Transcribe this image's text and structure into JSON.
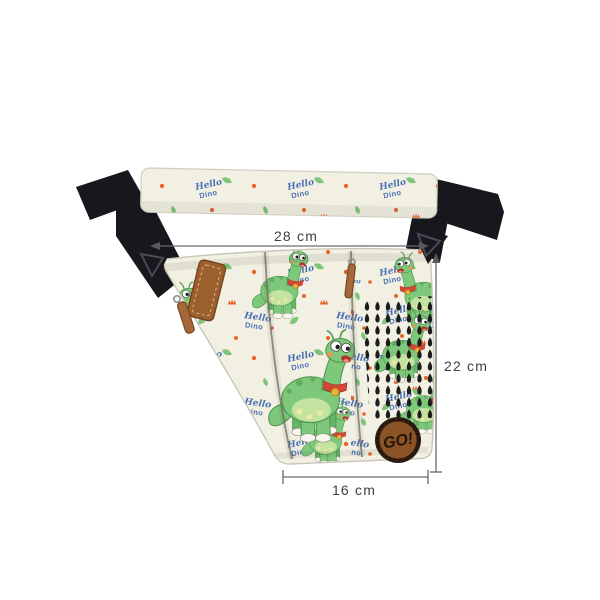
{
  "annotations": {
    "top_width_label": "28 cm",
    "side_height_label": "22 cm",
    "bottom_width_label": "16 cm"
  },
  "bag": {
    "print": {
      "hello": "Hello",
      "dino": "Dino"
    },
    "badge_label": "GO!"
  },
  "colors": {
    "background": "#ffffff",
    "fabric_cream": "#f1f0e2",
    "strap_black": "#17171d",
    "dino_green": "#7ec87b",
    "leaf_green": "#7ec57a",
    "print_blue": "#4b6fb5",
    "accent_orange": "#e8632c",
    "collar_red": "#d64535",
    "leather_brown": "#9c5f2e",
    "badge_brown": "#8a5426",
    "tree_black": "#1d1d1d",
    "dimension_line_gray": "#6a6a6a",
    "dimension_text_gray": "#3f3f3f"
  }
}
